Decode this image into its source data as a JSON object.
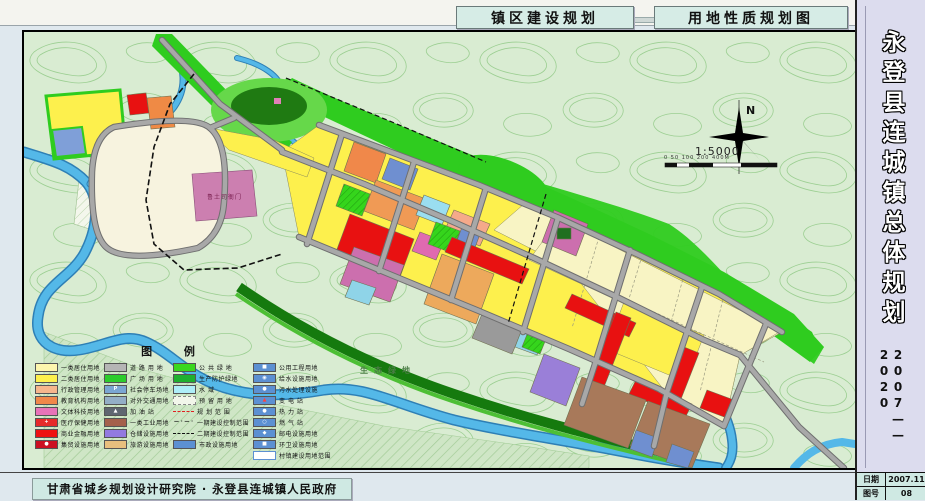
{
  "page": {
    "top_titles": {
      "left": "镇区建设规划",
      "right": "用地性质规划图"
    }
  },
  "sidebar": {
    "title": "永登县连城镇总体规划",
    "period": "2007——2020",
    "info_rows": [
      {
        "label": "日期",
        "value": "2007.11"
      },
      {
        "label": "图号",
        "value": "08"
      }
    ]
  },
  "footer": {
    "credit": "甘肃省城乡规划设计研究院 · 永登县连城镇人民政府"
  },
  "map": {
    "labels": {
      "historic_site": "鲁土司衙门",
      "eco_green": "生态绿地"
    },
    "compass": {
      "north": "N",
      "scale": "1:5000",
      "scale_bar": "0  50 100      200                 400M"
    }
  },
  "legend": {
    "title": "图    例",
    "columns": [
      [
        {
          "label": "一类居住用地",
          "color": "#fdf6ae"
        },
        {
          "label": "二类居住用地",
          "color": "#fdf04d"
        },
        {
          "label": "行政管理用地",
          "color": "#f6b68c"
        },
        {
          "label": "教育机构用地",
          "color": "#f0884a"
        },
        {
          "label": "文体科技用地",
          "color": "#e873b8"
        },
        {
          "label": "医疗保健用地",
          "color": "#e62a2a",
          "glyph": "+",
          "glyph_color": "#ffffff"
        },
        {
          "label": "商业金融用地",
          "color": "#ee1111"
        },
        {
          "label": "集贸设施用地",
          "color": "#cc1022",
          "glyph": "●",
          "glyph_color": "#ffffff"
        }
      ],
      [
        {
          "label": "道 路 用 地",
          "color": "#b5b5b5"
        },
        {
          "label": "广 场 用 地",
          "color": "#2ccc2c"
        },
        {
          "label": "社会停车场地",
          "color": "#7aa6d2",
          "glyph": "P",
          "glyph_color": "#ffffff"
        },
        {
          "label": "对外交通用地",
          "color": "#93aec6"
        },
        {
          "label": "加 油 站",
          "color": "#5f6670",
          "glyph": "▲",
          "glyph_color": "#ffffff"
        },
        {
          "label": "一类工业用地",
          "color": "#a4604c"
        },
        {
          "label": "仓储设施用地",
          "color": "#927ae0"
        },
        {
          "label": "旅游设施用地",
          "color": "#e8bf7e"
        }
      ],
      [
        {
          "label": "公 共 绿 地",
          "color": "#3ad81f"
        },
        {
          "label": "生产防护绿地",
          "color": "#1fb02f"
        },
        {
          "label": "水    域",
          "color": "#aeeef8"
        },
        {
          "label": "预 留 用 地",
          "color": "#f2f6ea",
          "style": "swatch-dashed"
        },
        {
          "label": "规 划 范 围",
          "style": "line-red-dash"
        },
        {
          "label": "一期建设控制范围",
          "style": "line-black-dashdot"
        },
        {
          "label": "二期建设控制范围",
          "style": "line-black-dash"
        },
        {
          "label": "市政设施用地",
          "color": "#5c90d2"
        }
      ],
      [
        {
          "label": "公用工程用地",
          "color": "#5c90d2",
          "glyph": "■",
          "glyph_color": "#ffffff"
        },
        {
          "label": "给水设施用地",
          "color": "#5c90d2",
          "glyph": "◉",
          "glyph_color": "#ffffff"
        },
        {
          "label": "污水处理设施",
          "color": "#5c90d2",
          "glyph": "●",
          "glyph_color": "#ffffff"
        },
        {
          "label": "变 电 站",
          "color": "#5c90d2",
          "glyph": "▲",
          "glyph_color": "#ff4040"
        },
        {
          "label": "热 力 站",
          "color": "#5c90d2",
          "glyph": "●",
          "glyph_color": "#ffffff"
        },
        {
          "label": "燃 气 站",
          "color": "#5c90d2",
          "glyph": "○",
          "glyph_color": "#ffffff"
        },
        {
          "label": "邮电设施用地",
          "color": "#5c90d2",
          "glyph": "◆",
          "glyph_color": "#ffffff"
        },
        {
          "label": "环卫设施用地",
          "color": "#5c90d2",
          "glyph": "■",
          "glyph_color": "#ffffff"
        },
        {
          "label": "村镇建设用地范围",
          "style": "box-outline"
        }
      ]
    ]
  },
  "colors": {
    "residential1": "#fdf6ae",
    "residential2": "#fdf04d",
    "commercial": "#ee1111",
    "education": "#f0884a",
    "culture": "#cc6fae",
    "industry": "#a4604c",
    "warehouse": "#927ae0",
    "utility_blue": "#5c90d2",
    "green_public": "#35d51c",
    "green_protect": "#1fb02f",
    "water": "#4db3e6",
    "road": "#9b9b9b",
    "topo_bg": "#d9ecd2"
  }
}
